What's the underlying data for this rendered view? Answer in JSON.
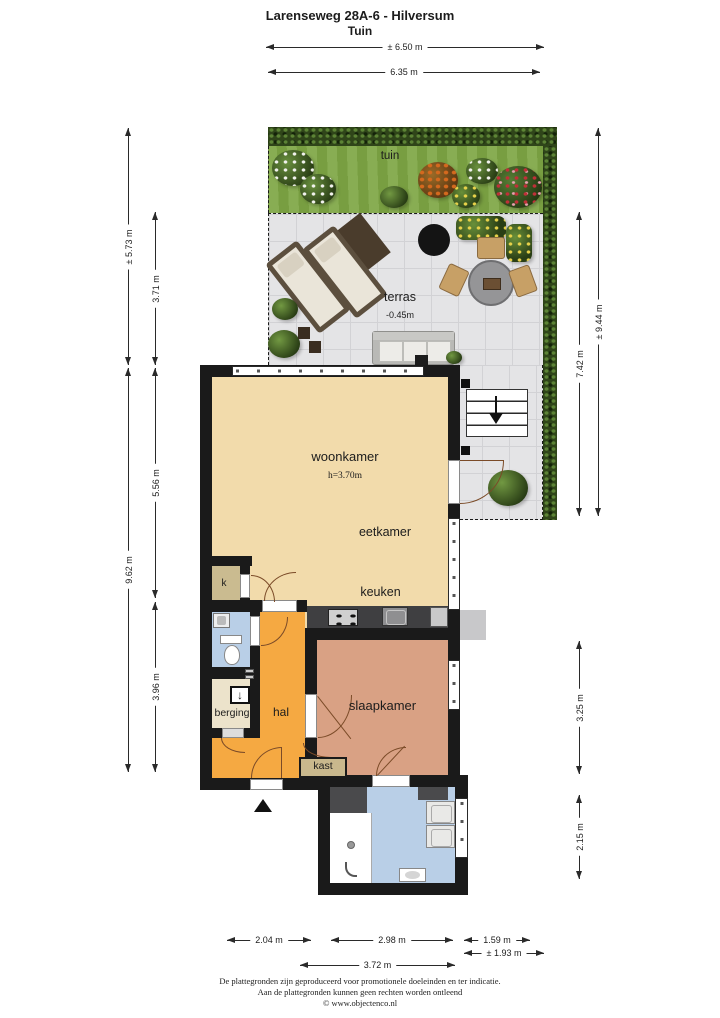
{
  "title": {
    "line1": "Larenseweg 28A-6 - Hilversum",
    "line2": "Tuin"
  },
  "rooms": {
    "tuin": "tuin",
    "terras": "terras",
    "terras_level": "-0.45m",
    "woonkamer": "woonkamer",
    "woonkamer_height": "h=3.70m",
    "eetkamer": "eetkamer",
    "keuken": "keuken",
    "slaapkamer": "slaapkamer",
    "hal": "hal",
    "berging": "berging",
    "kast": "kast",
    "k": "k"
  },
  "dims": {
    "top": [
      "± 6.50 m",
      "6.35 m"
    ],
    "left": [
      "± 5.73 m",
      "3.71 m",
      "9.62 m",
      "5.56 m",
      "3.96 m"
    ],
    "right": [
      "± 9.44 m",
      "7.42 m",
      "3.25 m",
      "2.15 m"
    ],
    "bottom": [
      "2.04 m",
      "2.98 m",
      "1.59 m",
      "3.72 m",
      "± 1.93 m"
    ]
  },
  "icons": {
    "meter_cupboard": "↓"
  },
  "footer": {
    "line1": "De plattegronden zijn geproduceerd voor promotionele doeleinden en ter indicatie.",
    "line2": "Aan de plattegronden kunnen geen rechten worden ontleend",
    "line3": "© www.objectenco.nl"
  },
  "colors": {
    "wall": "#1a1a1a",
    "living_floor": "#f2dbab",
    "hall_floor": "#f5a942",
    "bedroom_floor": "#d9a184",
    "bath_floor": "#b9cfe7",
    "closet_floor": "#c9b88d",
    "terrace_tile": "#e3e3e5",
    "grass": "#7ea644",
    "hedge": "#2f4519"
  }
}
